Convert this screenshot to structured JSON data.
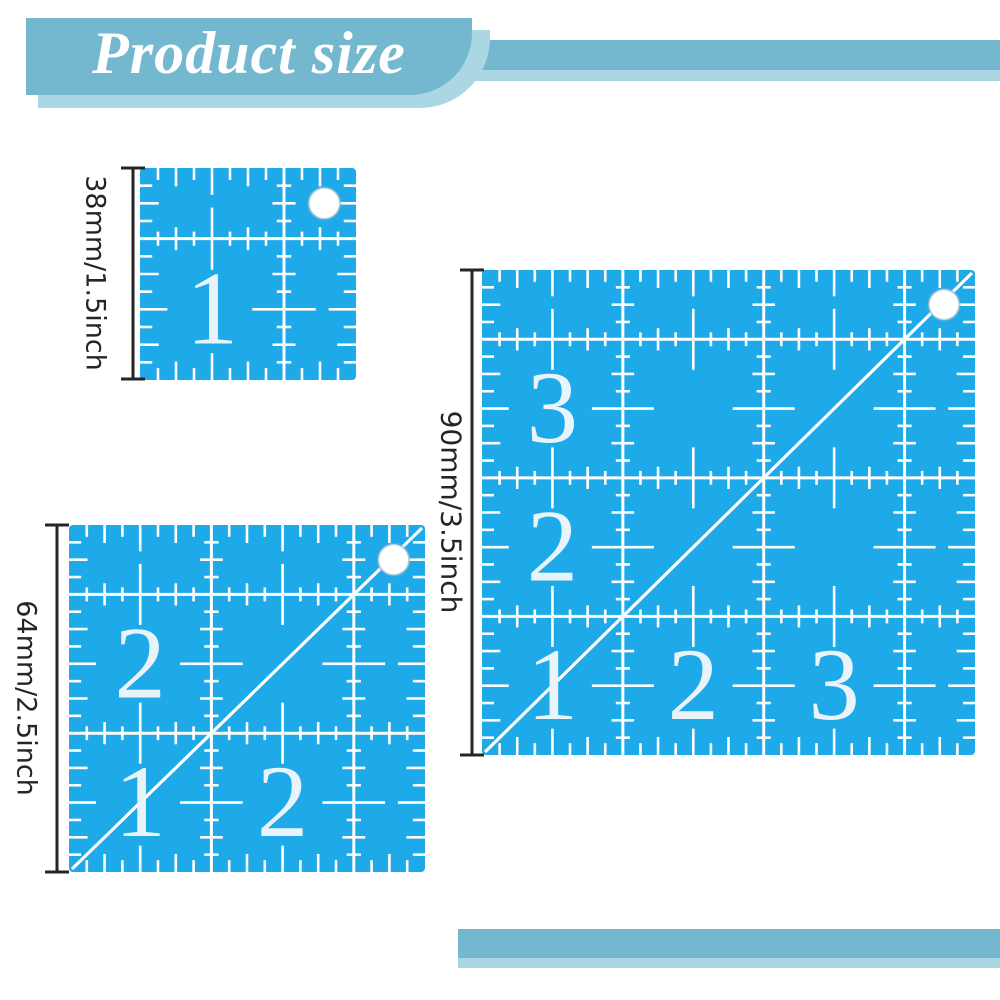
{
  "title": {
    "text": "Product size"
  },
  "colors": {
    "accent_bar": "#74b8cf",
    "accent_bar_light": "#abd6e3",
    "ruler_blue": "#1ea9e8",
    "marking_white": "#ffffff",
    "numeral_color": "#e8f3fa",
    "dimension_color": "#252525",
    "title_color": "#ffffff"
  },
  "rulers": [
    {
      "id": "small",
      "dimension_label": "38mm/1.5inch",
      "inches": 1.5,
      "numerals": [
        {
          "label": "1",
          "col": 0,
          "row": 0
        }
      ],
      "has_diagonal": false,
      "has_hole": true
    },
    {
      "id": "medium",
      "dimension_label": "64mm/2.5inch",
      "inches": 2.5,
      "numerals": [
        {
          "label": "2",
          "col": 0,
          "row": 1
        },
        {
          "label": "1",
          "col": 0,
          "row": 0
        },
        {
          "label": "2",
          "col": 1,
          "row": 0
        }
      ],
      "has_diagonal": true,
      "has_hole": true
    },
    {
      "id": "large",
      "dimension_label": "90mm/3.5inch",
      "inches": 3.5,
      "numerals": [
        {
          "label": "3",
          "col": 0,
          "row": 2
        },
        {
          "label": "2",
          "col": 0,
          "row": 1
        },
        {
          "label": "1",
          "col": 0,
          "row": 0
        },
        {
          "label": "2",
          "col": 1,
          "row": 0
        },
        {
          "label": "3",
          "col": 2,
          "row": 0
        }
      ],
      "has_diagonal": true,
      "has_hole": true
    }
  ]
}
